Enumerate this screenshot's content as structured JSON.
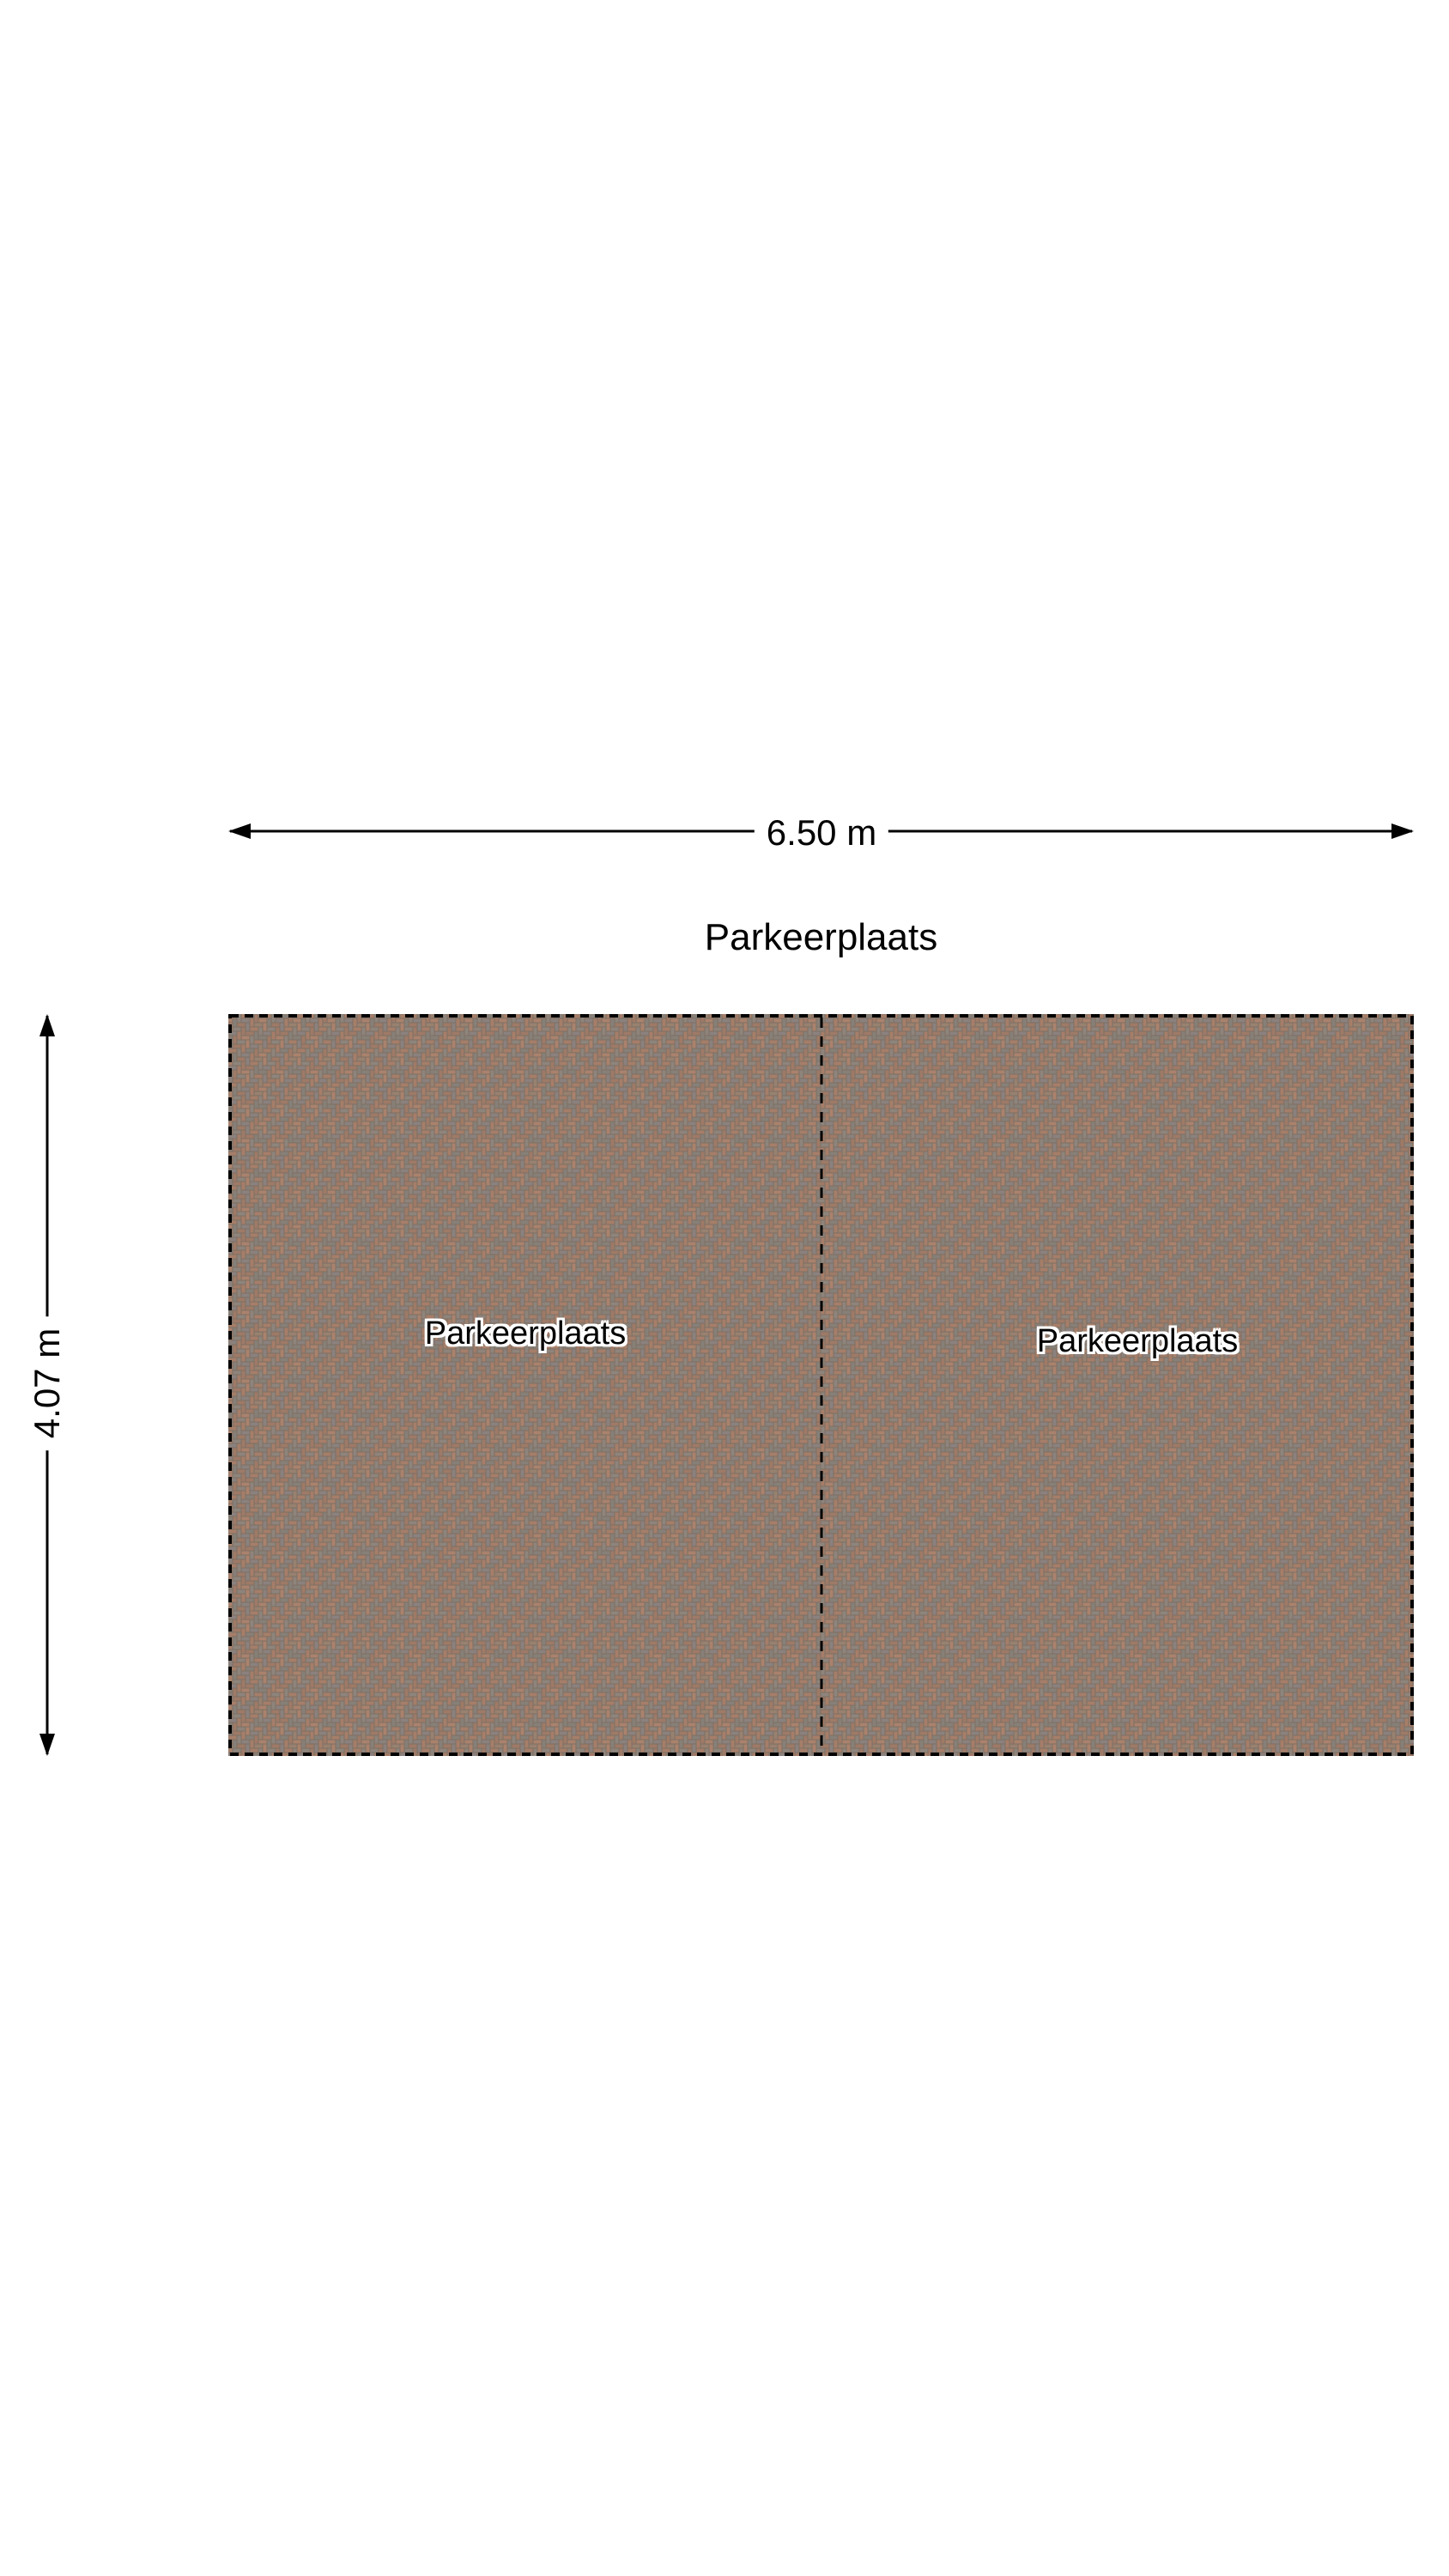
{
  "plan": {
    "title": "Parkeerplaats",
    "width_label": "6.50 m",
    "height_label": "4.07 m",
    "spaces": [
      {
        "label": "Parkeerplaats"
      },
      {
        "label": "Parkeerplaats"
      }
    ],
    "colors": {
      "line": "#000000",
      "background": "#ffffff",
      "paver_mortar": "#7d7064",
      "paver_red": "#a67e69",
      "paver_red_dark": "#9e7a67",
      "paver_red_light": "#aa826d",
      "paver_gray": "#8b817e",
      "paver_gray_light": "#8e847c",
      "paver_gray_dark": "#878078",
      "paver_brown": "#98816f"
    }
  }
}
